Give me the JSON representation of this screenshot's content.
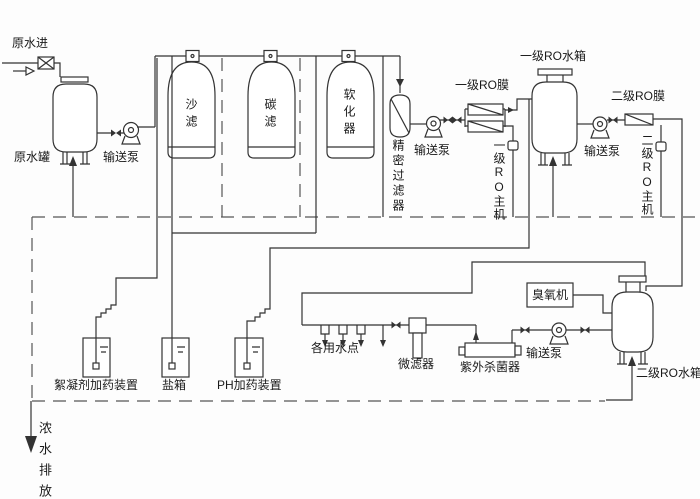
{
  "diagram_title": "two-stage RO water treatment process flow",
  "colors": {
    "line": "#333333",
    "dashed_drain": "#555555",
    "text": "#1a1a1a",
    "background": "#fdfdfd"
  },
  "labels": {
    "raw_water_in": "原水进",
    "raw_water_tank": "原水罐",
    "transfer_pump_1": "输送泵",
    "sand_filter": "沙滤",
    "carbon_filter": "碳滤",
    "softener": "软化器",
    "precision_filter": "精密过滤器",
    "transfer_pump_2": "输送泵",
    "ro1_membrane": "一级RO膜",
    "ro1_main_unit": "一级RO主机",
    "ro1_tank": "一级RO水箱",
    "transfer_pump_3": "输送泵",
    "ro2_membrane": "二级RO膜",
    "ro2_main_unit": "二级RO主机",
    "flocculant_doser": "絮凝剂加药装置",
    "salt_tank": "盐箱",
    "ph_doser": "PH加药装置",
    "use_points": "各用水点",
    "micro_filter": "微滤器",
    "uv_sterilizer": "紫外杀菌器",
    "transfer_pump_4": "输送泵",
    "ozone_machine": "臭氧机",
    "ro2_tank": "二级RO水箱",
    "concentrate_discharge": "浓水排放"
  }
}
